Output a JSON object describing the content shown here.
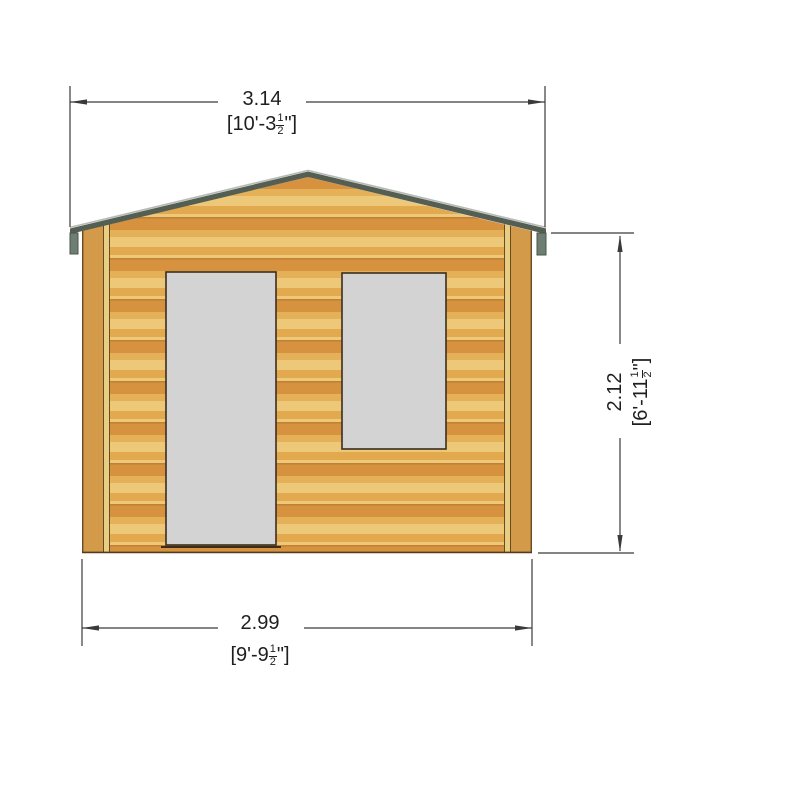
{
  "dimensions": {
    "overall_width": {
      "metric": "3.14",
      "imperial_prefix": "[10'-3",
      "frac_num": "1",
      "frac_den": "2",
      "imperial_suffix": "\"]"
    },
    "eaves_height": {
      "metric": "2.12",
      "imperial_prefix": "[6'-11",
      "frac_num": "1",
      "frac_den": "2",
      "imperial_suffix": "\"]"
    },
    "base_width": {
      "metric": "2.99",
      "imperial_prefix": "[9'-9",
      "frac_num": "1",
      "frac_den": "2",
      "imperial_suffix": "\"]"
    }
  },
  "colors": {
    "background": "#ffffff",
    "wood_dark": "#d6923f",
    "wood_mid": "#e5b158",
    "wood_light": "#ecc878",
    "wood_mid2": "#e2a94f",
    "corner_board": "#d39a49",
    "corner_strip": "#e6cf82",
    "outline_brown": "#6b4a22",
    "roof_fascia": "#545e53",
    "roof_fascia_light": "#b7bab4",
    "eave_cap": "#6e7e73",
    "panel_gray": "#d3d3d3",
    "panel_outline": "#3b2d1d",
    "dim_line": "#3a3a3a"
  }
}
